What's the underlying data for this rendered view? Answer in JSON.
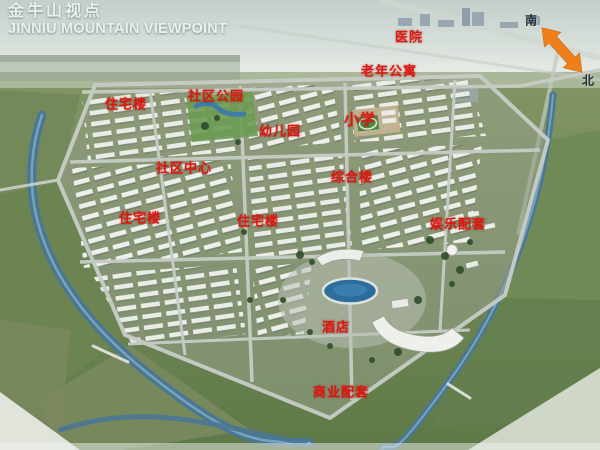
{
  "title": {
    "zh": "金牛山视点",
    "en": "JINNIU MOUNTAIN VIEWPOINT"
  },
  "compass": {
    "south": "南",
    "north": "北",
    "arrow_color": "#ef7f1a"
  },
  "label_color": "#e0170f",
  "labels": [
    {
      "id": "hospital",
      "text": "医院",
      "x": 409,
      "y": 36
    },
    {
      "id": "senior-apartments",
      "text": "老年公寓",
      "x": 389,
      "y": 70
    },
    {
      "id": "residential-1",
      "text": "住宅楼",
      "x": 126,
      "y": 103
    },
    {
      "id": "community-park",
      "text": "社区公园",
      "x": 216,
      "y": 95
    },
    {
      "id": "primary-school",
      "text": "小学",
      "x": 360,
      "y": 119
    },
    {
      "id": "kindergarten",
      "text": "幼儿园",
      "x": 280,
      "y": 130
    },
    {
      "id": "community-center",
      "text": "社区中心",
      "x": 184,
      "y": 167
    },
    {
      "id": "complex-building",
      "text": "综合楼",
      "x": 352,
      "y": 176
    },
    {
      "id": "residential-2",
      "text": "住宅楼",
      "x": 140,
      "y": 217
    },
    {
      "id": "residential-3",
      "text": "住宅楼",
      "x": 258,
      "y": 220
    },
    {
      "id": "entertainment",
      "text": "娱乐配套",
      "x": 458,
      "y": 223
    },
    {
      "id": "hotel",
      "text": "酒店",
      "x": 336,
      "y": 326
    },
    {
      "id": "commercial",
      "text": "商业配套",
      "x": 341,
      "y": 391
    }
  ]
}
